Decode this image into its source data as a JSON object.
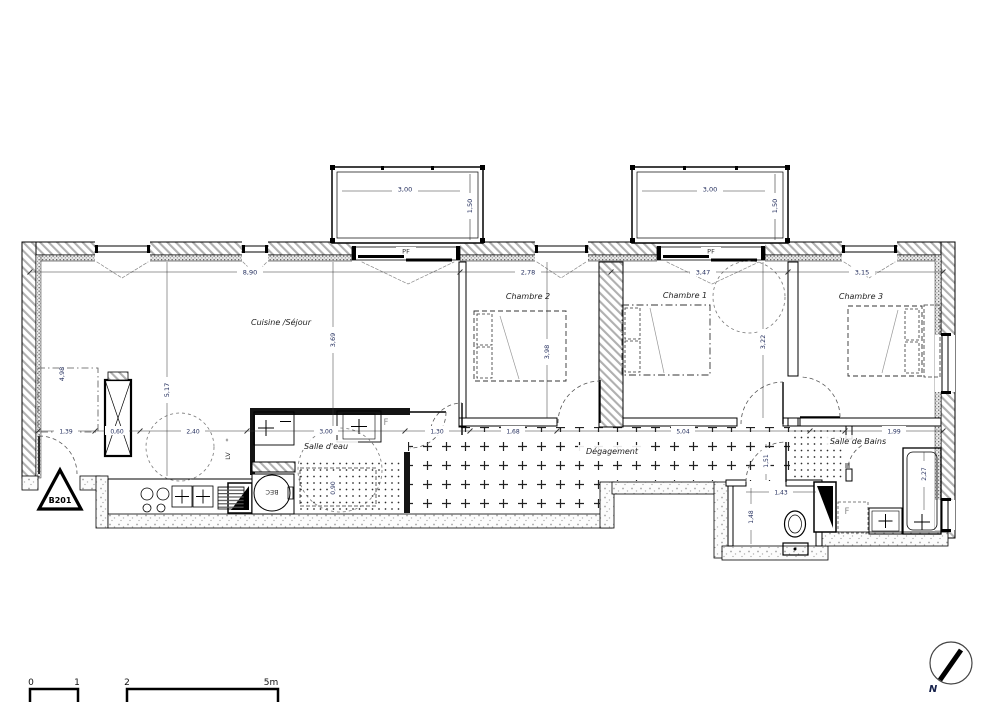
{
  "floorplan": {
    "unit": "B201",
    "north": "N",
    "rooms": {
      "cuisine_sejour": "Cuisine /Séjour",
      "chambre2": "Chambre 2",
      "chambre1": "Chambre 1",
      "chambre3": "Chambre 3",
      "salle_deau": "Salle d'eau",
      "salle_de_bains": "Salle de Bains",
      "degagement": "Dégagement"
    },
    "openings": {
      "pf1": "PF",
      "pf2": "PF"
    },
    "fixtures": {
      "lave_vaisselle": "LV",
      "lave_vaisselle_star": "*",
      "washer": "BEC",
      "fenetre_salle_deau": "F",
      "reserve_salle_de_bains": "F"
    },
    "dims": {
      "bal1_w": "3,00",
      "bal1_d": "1,50",
      "bal2_w": "3,00",
      "bal2_d": "1,50",
      "top_cuisine": "8,90",
      "top_chambre2": "2,78",
      "top_chambre1": "3,47",
      "top_chambre3": "3,15",
      "h_cuisine": "3,69",
      "h_chambre2": "3,98",
      "h_chambre1": "3,22",
      "left_placard": "4,98",
      "kitchen_run": "5,17",
      "bottom_entree": "1,39",
      "bottom_gaine": "0,60",
      "bottom_cuisine": "2,40",
      "bottom_salle_deau": "3,00",
      "bottom_1": "1,30",
      "bottom_2": "1,68",
      "bottom_degagement": "5,04",
      "bottom_salle_de_bains": "1,99",
      "douche": "0,90",
      "baignoire": "2,27",
      "wc_largeur": "1,43",
      "wc_profondeur": "1,48",
      "wc_porte": "1,51"
    },
    "scale_bar": {
      "t0": "0",
      "t1": "1",
      "t2": "2",
      "t5": "5m"
    }
  }
}
